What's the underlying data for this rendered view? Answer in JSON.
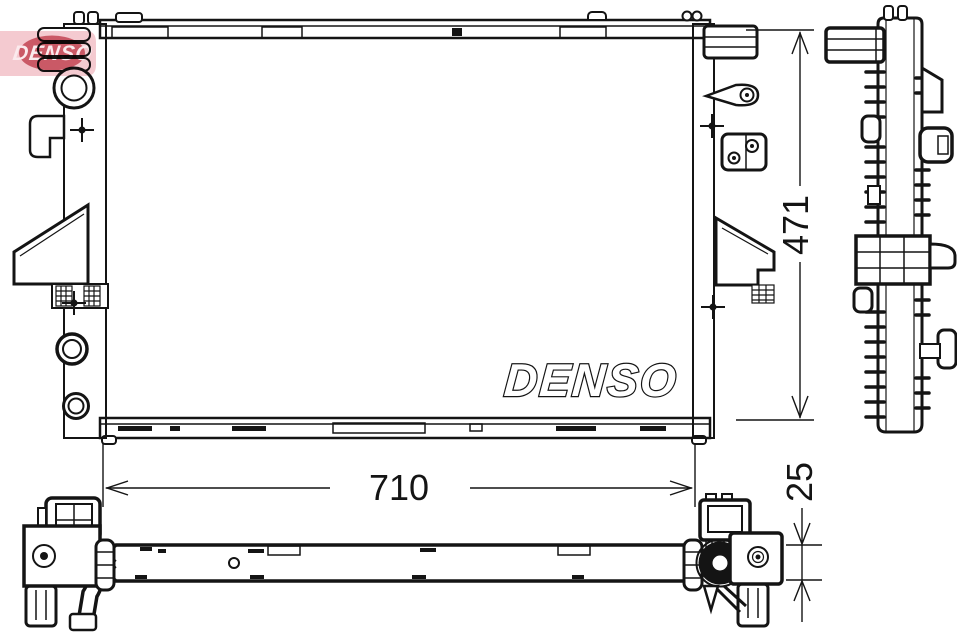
{
  "watermark": {
    "text": "DENSO"
  },
  "front_view": {
    "brand_label": "DENSO"
  },
  "dimensions": {
    "height": "471",
    "width": "710",
    "thickness": "25"
  },
  "colors": {
    "line": "#141414",
    "fin": "#8f8f8f",
    "rib": "#2b2b2b",
    "watermark_band": "#f3c6cc",
    "watermark_ellipse": "#c64b59",
    "watermark_text": "#fbe9ec"
  }
}
